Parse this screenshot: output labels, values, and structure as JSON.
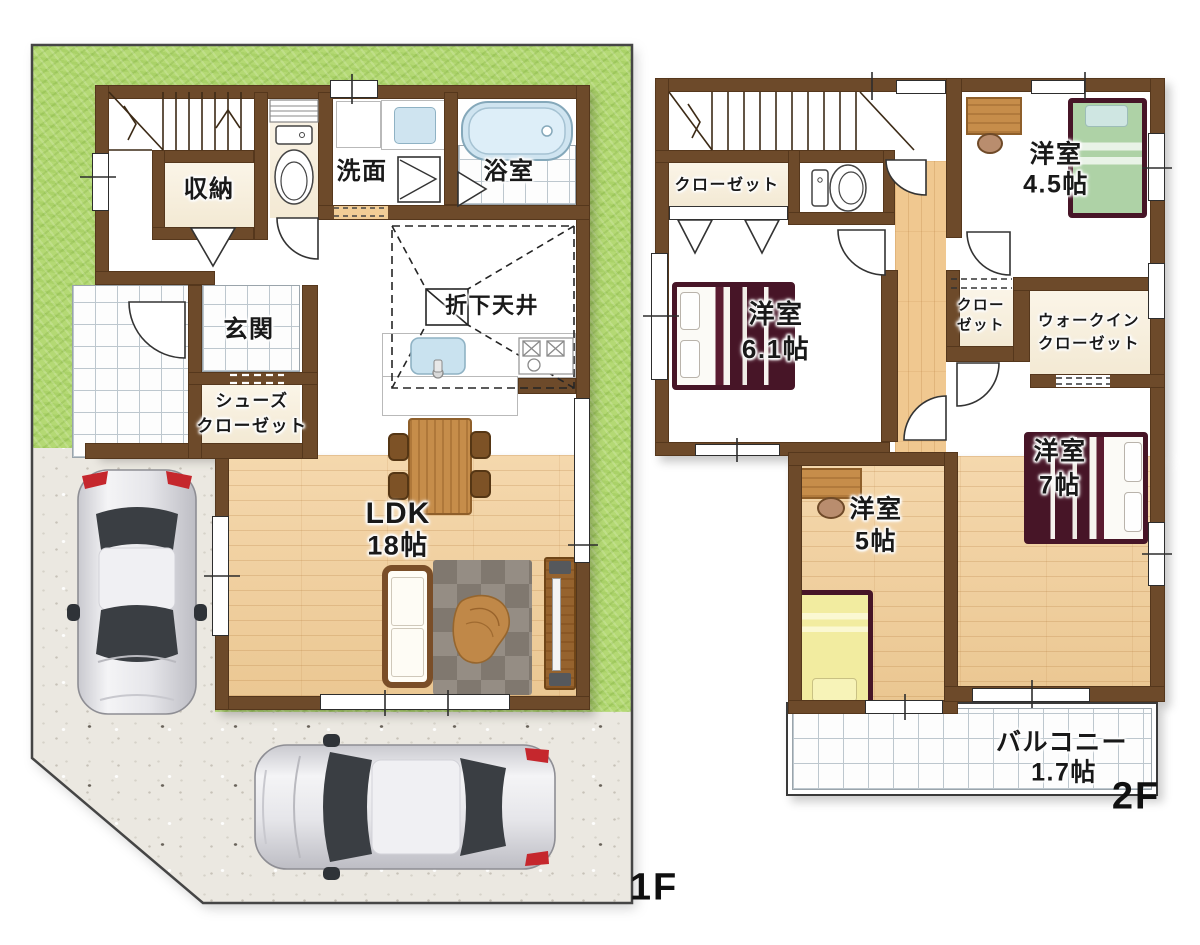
{
  "colors": {
    "wall": "#6d4a2a",
    "wood_floor": "#f2cd96",
    "grass": "#b4d974",
    "concrete": "#ebe8e1",
    "tile_white": "#fdfdfd",
    "bathtub": "#cfe4f0",
    "bed_maroon": "#471527",
    "bed_green": "#aed2a6",
    "bed_yellow": "#f2eca0",
    "furniture_wood": "#c68d4a",
    "rug_gray": "#8a8279",
    "label_text": "#191919"
  },
  "floor1": {
    "label": "1F",
    "rooms": {
      "storage": "収納",
      "washroom": "洗面",
      "bathroom": "浴室",
      "entrance": "玄関",
      "shoe_closet_line1": "シューズ",
      "shoe_closet_line2": "クローゼット",
      "lowered_ceiling": "折下天井",
      "ldk_name": "LDK",
      "ldk_size": "18帖"
    }
  },
  "floor2": {
    "label": "2F",
    "rooms": {
      "closet_west": "クローゼット",
      "bedroom45_name": "洋室",
      "bedroom45_size": "4.5帖",
      "bedroom61_name": "洋室",
      "bedroom61_size": "6.1帖",
      "closet_center_line1": "クロー",
      "closet_center_line2": "ゼット",
      "wic_line1": "ウォークイン",
      "wic_line2": "クローゼット",
      "bedroom5_name": "洋室",
      "bedroom5_size": "5帖",
      "bedroom7_name": "洋室",
      "bedroom7_size": "7帖",
      "balcony_name": "バルコニー",
      "balcony_size": "1.7帖"
    }
  }
}
